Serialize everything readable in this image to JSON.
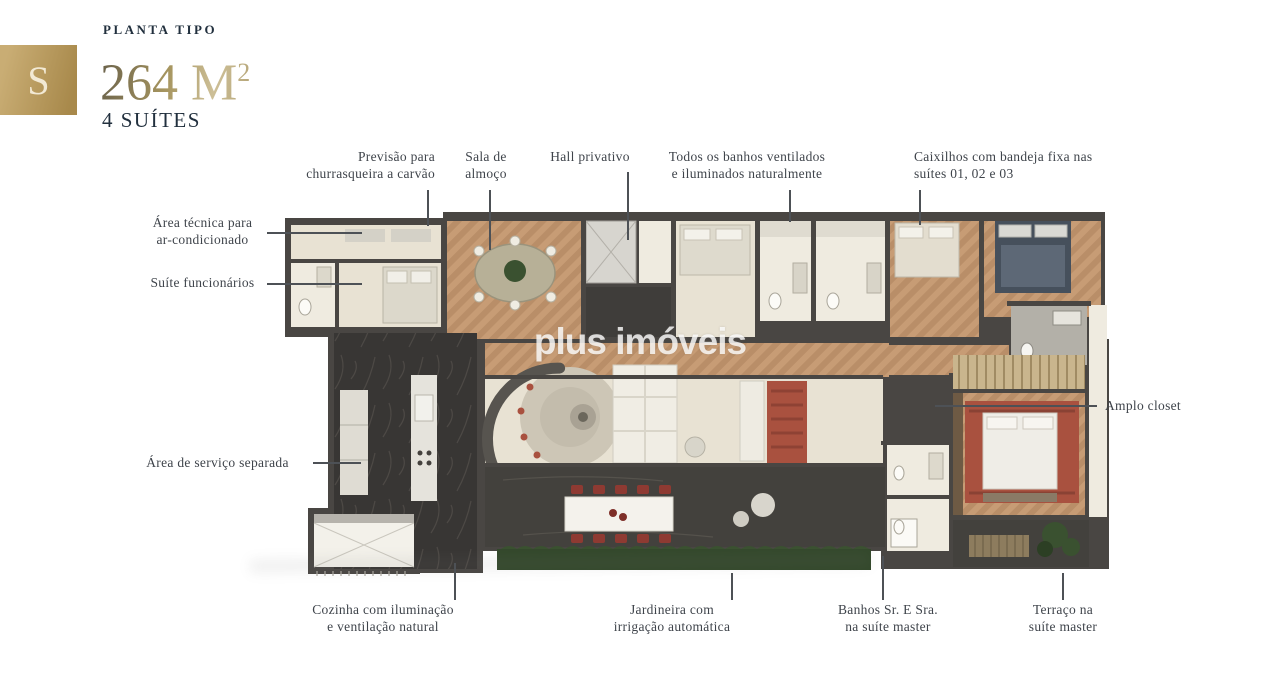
{
  "header": {
    "badge_letter": "S",
    "eyebrow": "PLANTA TIPO",
    "area_value": "264 M",
    "area_sup": "2",
    "subtitle": "4 SUÍTES"
  },
  "watermark": "plus imóveis",
  "callouts": {
    "churrasqueira": {
      "text": "Previsão para\nchurrasqueira a carvão"
    },
    "sala_almoco": {
      "text": "Sala de\nalmoço"
    },
    "hall_privativo": {
      "text": "Hall privativo"
    },
    "banhos_ventilados": {
      "text": "Todos os banhos ventilados\ne iluminados naturalmente"
    },
    "caixilhos": {
      "text": "Caixilhos com bandeja fixa nas\nsuítes 01, 02 e 03"
    },
    "area_tecnica": {
      "text": "Área técnica para\nar-condicionado"
    },
    "suite_funcionarios": {
      "text": "Suíte funcionários"
    },
    "area_servico": {
      "text": "Área de serviço separada"
    },
    "amplo_closet": {
      "text": "Amplo closet"
    },
    "cozinha": {
      "text": "Cozinha com iluminação\ne ventilação natural"
    },
    "jardineira": {
      "text": "Jardineira com\nirrigação automática"
    },
    "banhos_master": {
      "text": "Banhos Sr. E Sra.\nna suíte master"
    },
    "terraco_master": {
      "text": "Terraço na\nsuíte master"
    }
  },
  "colors": {
    "gold_badge_start": "#c9ad74",
    "gold_badge_end": "#a8894b",
    "heading_navy": "#22303e",
    "label_ink": "#3f444b",
    "leader": "#4d5156",
    "area_gold_dark": "#6e654c",
    "area_gold_mid": "#a6955f",
    "area_gold_light": "#cdbf97",
    "wall": "#494643",
    "wood": "#c79c75",
    "wood_dark": "#b98e68",
    "marble": "#383634",
    "floor_beige": "#e8e2d3",
    "floor_white": "#efebe0",
    "terrace": "#43413d",
    "planter_green": "#33482b",
    "bush_green": "#3a5130",
    "rug_red": "#a9513f",
    "navy_bed": "#46505c"
  }
}
